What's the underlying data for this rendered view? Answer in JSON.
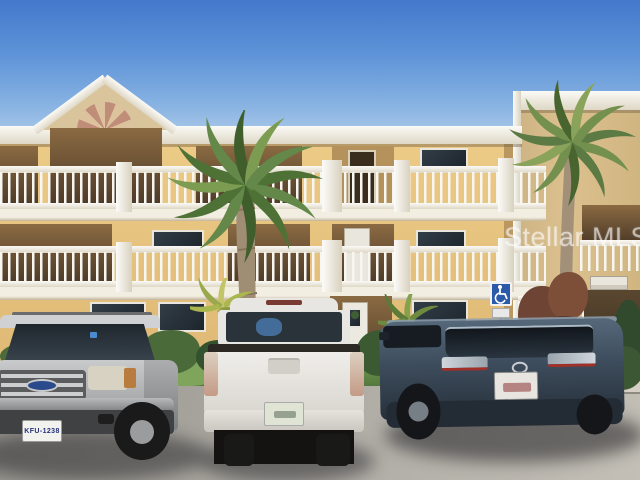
{
  "photo": {
    "watermark_text": "Stellar MLS",
    "scene_description": "Exterior photo of a three-story yellow condominium building with white balcony railings and a sunburst gable, palm trees, shrubs, and three vehicles parked in the front lot under a clear blue sky"
  },
  "building": {
    "floors": 3,
    "wall_color": "#e7c27c",
    "trim_color": "#f4f2ec",
    "features": [
      "sunburst-gable",
      "picket-balcony-railings",
      "covered-entry-with-wreath-door",
      "flat-roof-tower-section"
    ]
  },
  "signs": {
    "handicap_sign": {
      "symbol": "wheelchair",
      "background": "#2a5aa8"
    },
    "building_sign": {
      "text": ""
    }
  },
  "vehicles": [
    {
      "name": "silver-suv",
      "description": "silver Ford Explorer SUV, front view",
      "plate": "KFU-1238",
      "color": "#b0b2b4"
    },
    {
      "name": "white-pickup",
      "description": "white Toyota Tundra pickup with black tonneau cover, rear view",
      "plate": "",
      "color": "#eceae6"
    },
    {
      "name": "blue-gray-suv",
      "description": "dark blue-gray Toyota Highlander SUV, rear three-quarter view",
      "plate": "",
      "color": "#46586a"
    }
  ],
  "environment": {
    "sky": "clear blue",
    "vegetation": [
      "palm-trees",
      "shrubs",
      "grass-strip"
    ],
    "ground": "asphalt parking lot"
  }
}
